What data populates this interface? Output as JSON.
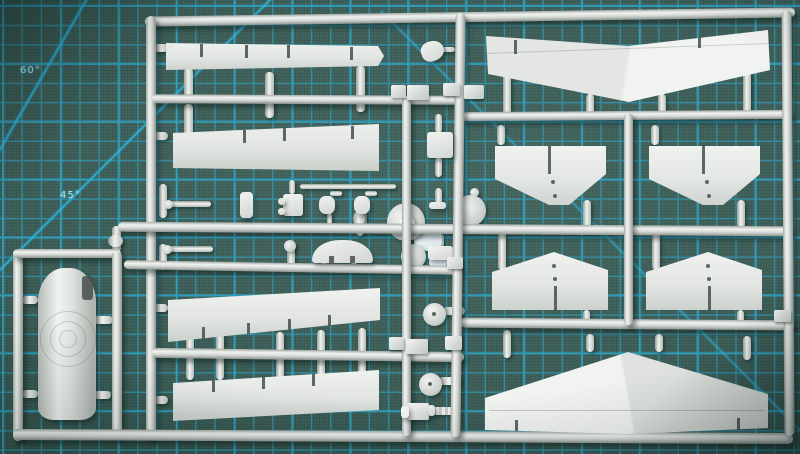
{
  "mat": {
    "labels": {
      "angle60": "60°",
      "angle45": "45°"
    },
    "colors": {
      "base": "#3f605a",
      "dark": "#2c4a44",
      "grid": "#2db5e0",
      "label": "#b8e9f6"
    }
  },
  "sprue": {
    "colors": {
      "plastic": "#d6d9d6",
      "bright": "#f1f3f1",
      "deep": "#8e948f",
      "clear": "#d9e7ee"
    }
  }
}
